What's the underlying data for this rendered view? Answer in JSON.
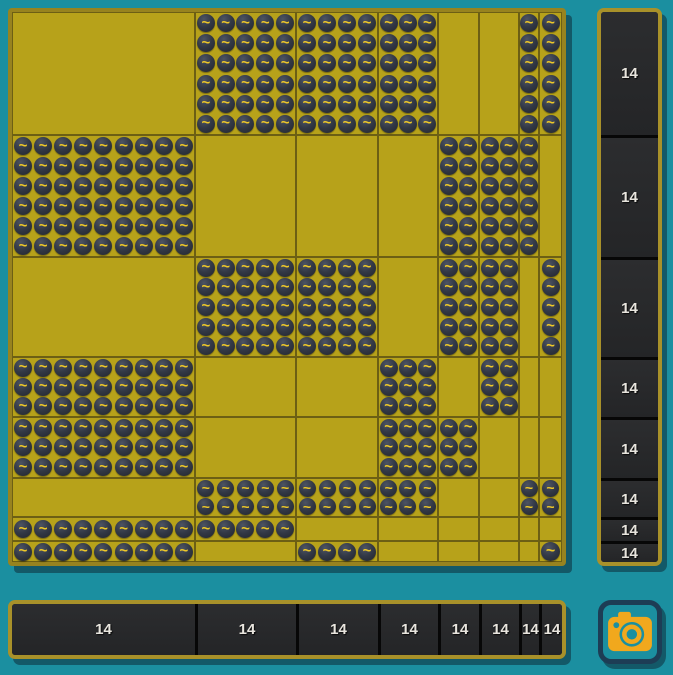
{
  "board": {
    "coin_symbol": "~",
    "row_bands": [
      {
        "cells": 6,
        "px": 123
      },
      {
        "cells": 6,
        "px": 122
      },
      {
        "cells": 5,
        "px": 100
      },
      {
        "cells": 3,
        "px": 60
      },
      {
        "cells": 3,
        "px": 61
      },
      {
        "cells": 2,
        "px": 39
      },
      {
        "cells": 1,
        "px": 24
      },
      {
        "cells": 1,
        "px": 21
      }
    ],
    "col_bands": [
      {
        "cells": 9,
        "px": 183
      },
      {
        "cells": 5,
        "px": 101
      },
      {
        "cells": 4,
        "px": 82
      },
      {
        "cells": 3,
        "px": 60
      },
      {
        "cells": 2,
        "px": 41
      },
      {
        "cells": 2,
        "px": 40
      },
      {
        "cells": 1,
        "px": 20
      },
      {
        "cells": 1,
        "px": 23
      }
    ],
    "fill_matrix": [
      [
        0,
        1,
        1,
        1,
        0,
        0,
        1,
        1
      ],
      [
        1,
        0,
        0,
        0,
        1,
        1,
        1,
        0
      ],
      [
        0,
        1,
        1,
        0,
        1,
        1,
        0,
        1
      ],
      [
        1,
        0,
        0,
        1,
        0,
        1,
        0,
        0
      ],
      [
        1,
        0,
        0,
        1,
        1,
        0,
        0,
        0
      ],
      [
        0,
        1,
        1,
        1,
        0,
        0,
        1,
        1
      ],
      [
        1,
        1,
        0,
        0,
        0,
        0,
        0,
        0
      ],
      [
        1,
        0,
        1,
        0,
        0,
        0,
        0,
        1
      ]
    ]
  },
  "right_panel": {
    "labels": [
      "14",
      "14",
      "14",
      "14",
      "14",
      "14",
      "14",
      "14"
    ]
  },
  "bottom_panel": {
    "labels": [
      "14",
      "14",
      "14",
      "14",
      "14",
      "14",
      "14",
      "14"
    ]
  },
  "camera_button": {
    "icon": "camera-icon"
  },
  "colors": {
    "background": "#1b8fa0",
    "board_gold": "#b7a21a",
    "board_frame": "#97831f",
    "grid_line": "#6c5f14",
    "coin_hi": "#4d5463",
    "coin_dark": "#323845",
    "coin_edge": "#22252d",
    "coin_glyph": "#eec829",
    "panel_bg": "#242527",
    "panel_bg_hi": "#2c2d2f",
    "panel_frame": "#a8912a",
    "panel_divider": "#070707",
    "label_text": "#e8e5de",
    "camera_gold": "#f1a81d",
    "camera_border": "#1d3d55",
    "shadow": "rgba(10,25,35,0.45)"
  }
}
